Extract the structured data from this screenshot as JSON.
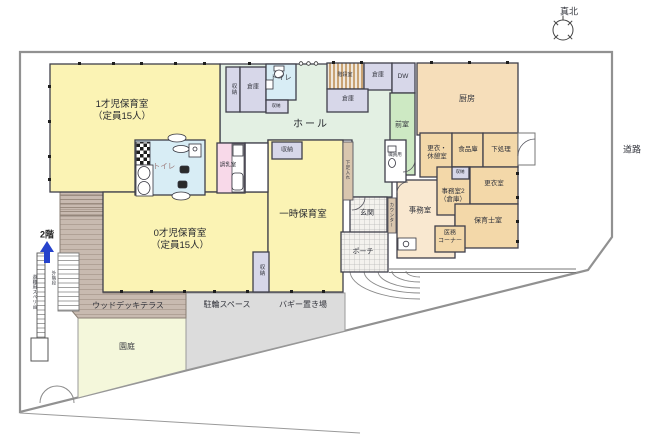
{
  "plan": {
    "north": "真北",
    "road": "道路",
    "floor2": "2階",
    "slide": "避難用スベリ台",
    "ext_stairs": "外階段"
  },
  "rooms": {
    "class1_name": "1才児保育室",
    "class1_cap": "（定員15人）",
    "class0_name": "0才児保育室",
    "class0_cap": "（定員15人）",
    "hall": "ホール",
    "temp_care": "一時保育室",
    "toilet_main": "トイレ",
    "toilet_top": "トイレ",
    "milk_room": "調乳室",
    "storage_v_top": "収納",
    "storage_small": "収納",
    "storage_temp": "収納",
    "storage_tiny": "収納",
    "storage_v_bottom": "収納",
    "souko_top": "倉庫",
    "souko_right": "倉庫",
    "souko_lower": "倉庫",
    "stairwell": "階段室",
    "dw": "DW",
    "kitchen": "厨房",
    "anteroom": "前室",
    "staff_toilet": "職員用",
    "change_break_1": "更衣・",
    "change_break_2": "休憩室",
    "food_storage": "食品庫",
    "prep": "下処理",
    "office2_1": "事務室2",
    "office2_2": "（倉庫）",
    "changing": "更衣室",
    "nursery_staff": "保育士室",
    "medical_1": "医務",
    "medical_2": "コーナー",
    "office": "事務室",
    "entrance": "玄関",
    "porch": "ポーチ",
    "shoe_box": "下足入れ",
    "counter": "カウンター"
  },
  "outdoor": {
    "deck": "ウッドデッキテラス",
    "bike": "駐輪スペース",
    "buggy": "バギー置き場",
    "garden": "園庭"
  },
  "colors": {
    "yellow": "#fbf3b4",
    "hall_green": "#e3f0e3",
    "ante_green": "#cde9c3",
    "blue": "#d8edf5",
    "lavender": "#d7d7e9",
    "pink": "#f8d9e9",
    "tan_kitchen": "#f6deba",
    "tan_room": "#f3d8a9",
    "tan_office": "#f9e8d0",
    "deck": "#c8bab0",
    "paving": "#dcdcdc",
    "garden": "#f4f7db",
    "shoe_tan": "#d9c6ae",
    "arrow_blue": "#2643cc"
  }
}
